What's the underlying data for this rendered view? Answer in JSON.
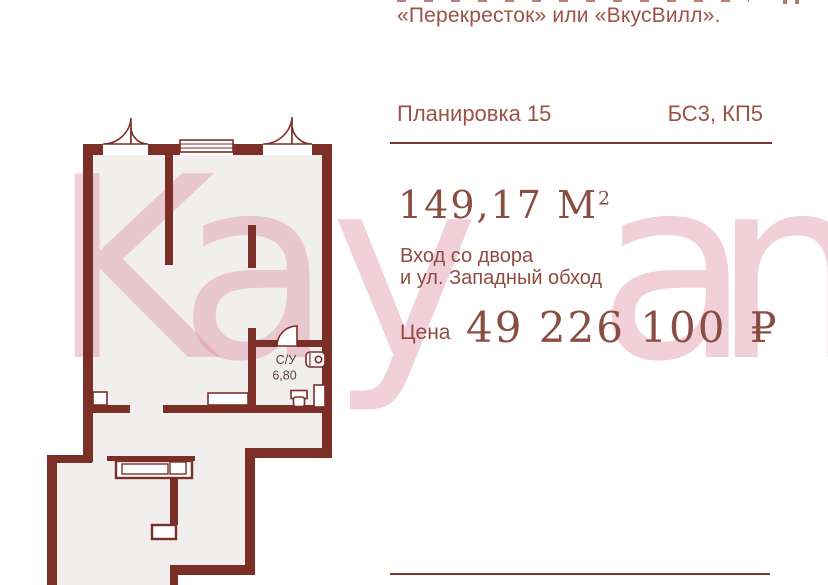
{
  "listing": {
    "intro_text": "«Перекресток» или «ВкусВилл».",
    "plan_name": "Планировка 15",
    "block_name": "БС3, КП5",
    "area_value": "149,17",
    "area_unit": "М",
    "area_sup": "2",
    "entrance_line1": "Вход со двора",
    "entrance_line2": "и ул. Западный обход",
    "price_label": "Цена",
    "price_value": "49 226 100",
    "price_currency": "₽"
  },
  "floorplan": {
    "bathroom_label": "С/У",
    "bathroom_area": "6,80",
    "wall_color": "#7c2f27",
    "floor_color": "#f0efee",
    "label_color": "#5e443e"
  },
  "watermark": {
    "text": "Kayan",
    "letters": [
      "K",
      "a",
      "y",
      "a",
      "n"
    ],
    "color": "#de8fa5"
  },
  "accents": {
    "rule_color": "#7a372e",
    "heading_color": "#9c5247",
    "body_color": "#8f4b41",
    "display_color": "#8a4d42"
  }
}
